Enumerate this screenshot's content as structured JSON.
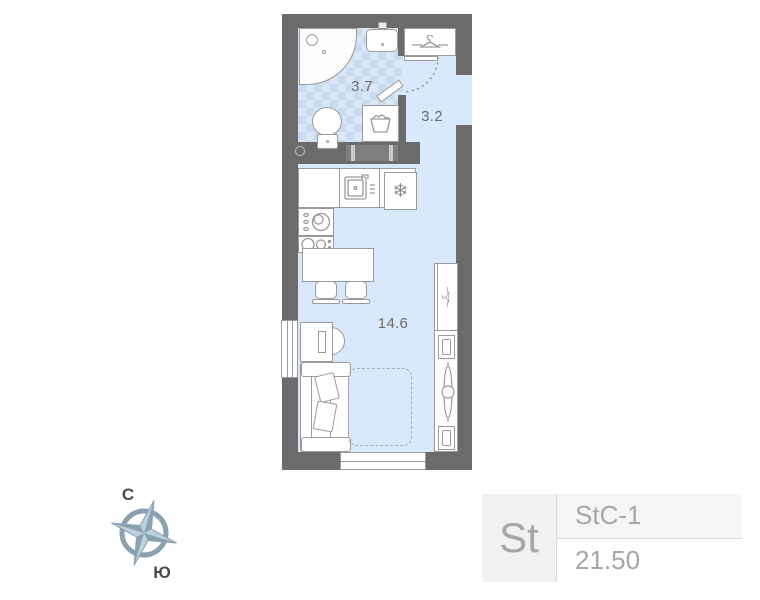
{
  "floor_plan": {
    "rooms": [
      {
        "name": "bathroom",
        "area": "3.7"
      },
      {
        "name": "hallway",
        "area": "3.2"
      },
      {
        "name": "living-room",
        "area": "14.6"
      }
    ]
  },
  "compass": {
    "north": "С",
    "south": "Ю"
  },
  "unit_card": {
    "type": "St",
    "layout_code": "StC-1",
    "area": "21.50"
  },
  "icons": {
    "fridge": "❄"
  },
  "colors": {
    "wall": "#6b6b6b",
    "floor": "#d7e9fb",
    "tile_light": "#d9e7f7",
    "tile_dark": "#c8dcf0",
    "outline": "#9a9a9a",
    "label_text": "#6d6d6d",
    "compass_main": "#8ba1b0",
    "compass_light": "#bad0dc",
    "card_bg": "#f1f1f2",
    "card_row_bg": "#f5f5f6",
    "card_text": "#a6a6a8",
    "card_divider": "#d9d9d9"
  }
}
